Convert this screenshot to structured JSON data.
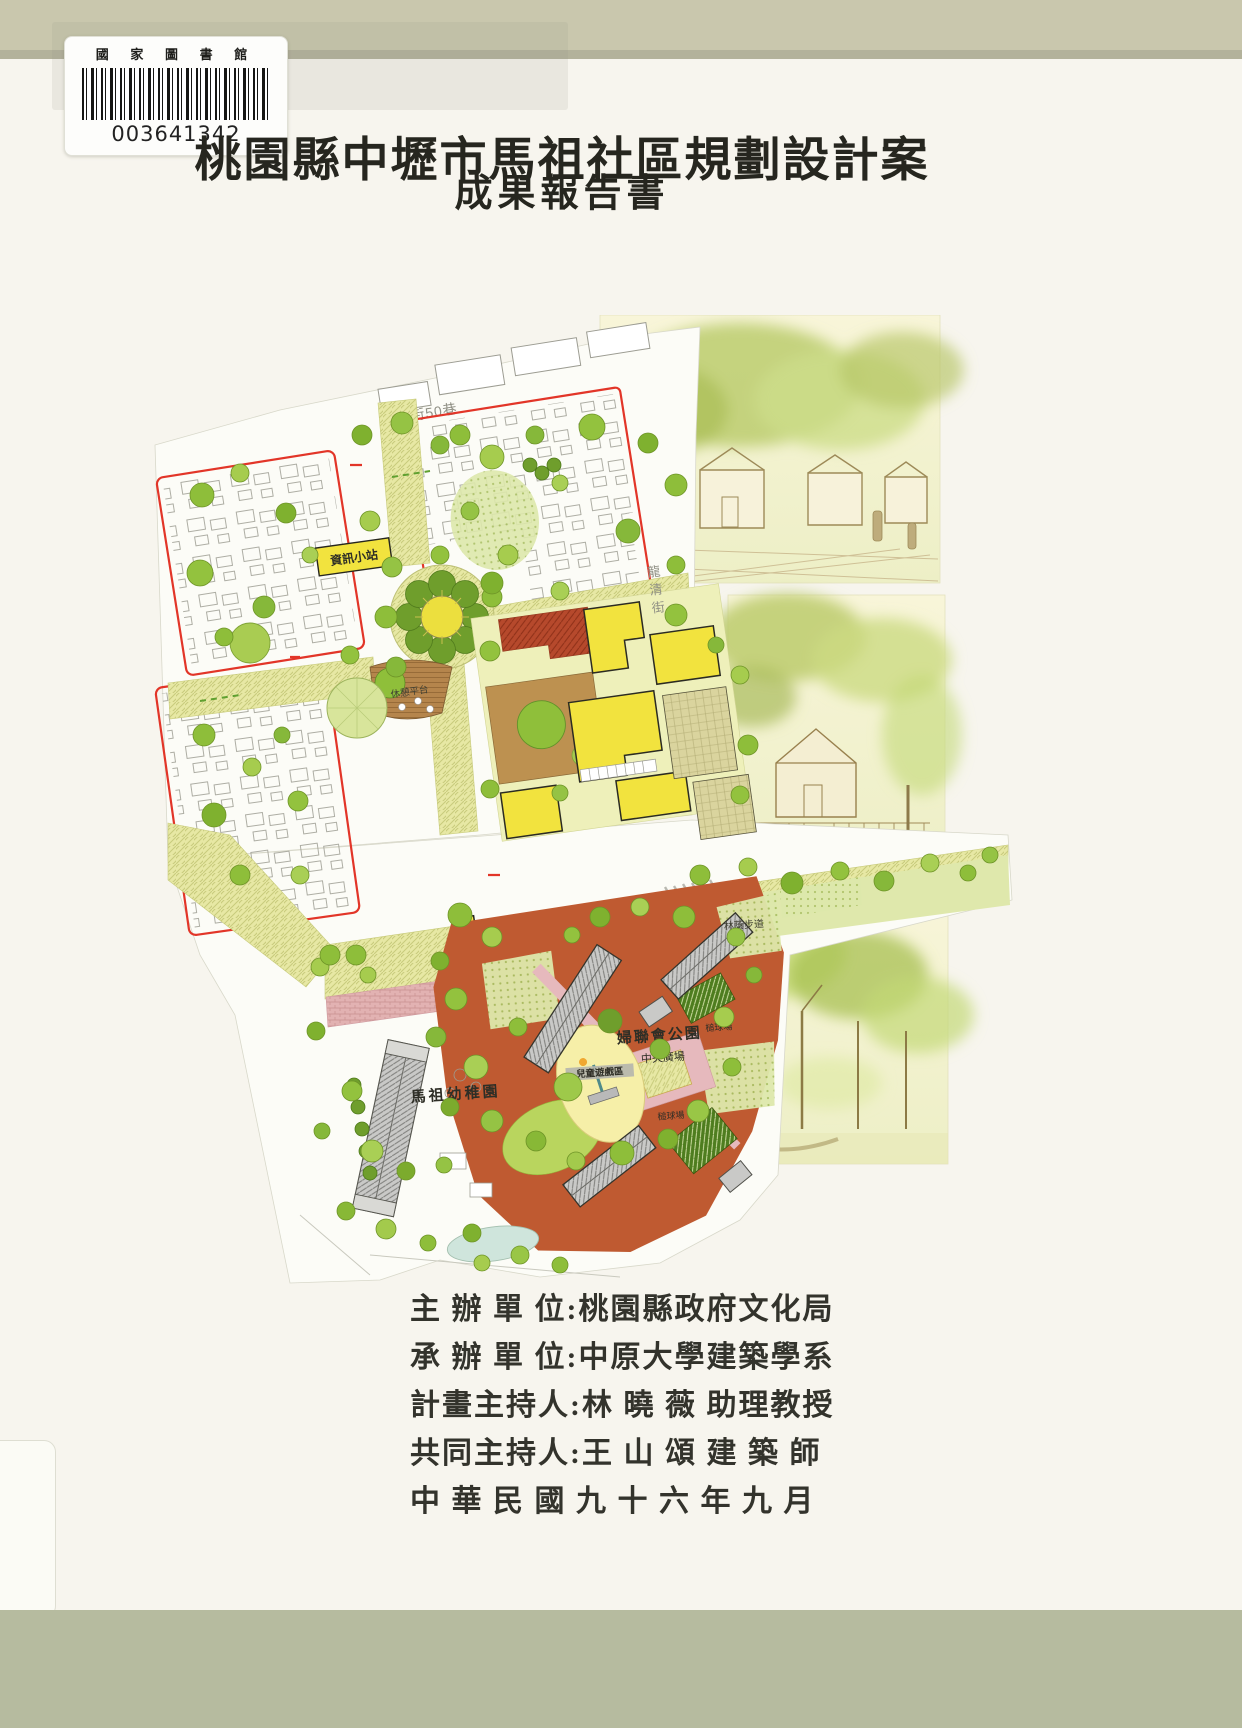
{
  "cover": {
    "library_label": {
      "institution": "國 家 圖 書 館",
      "barcode_number": "003641342"
    },
    "title": "桃園縣中壢市馬祖社區規劃設計案",
    "subtitle": "成果報告書",
    "credits": [
      "主 辦 單 位:桃園縣政府文化局",
      "承 辦 單 位:中原大學建築學系",
      "計畫主持人:林 曉 薇 助理教授",
      "共同主持人:王 山 頌 建 築 師",
      "中 華 民 國 九 十 六 年 九 月"
    ]
  },
  "site_plan": {
    "labels": {
      "street_top": "龍清街50巷",
      "street_right": "龍清街",
      "info_station": "資訊小站",
      "rest_deck": "休憩平台",
      "activity_center": "活動中心",
      "kindergarten": "馬祖幼稚園",
      "children_play_area": "兒童遊戲區",
      "womens_league_park": "婦聯會公園",
      "central_plaza": "中央廣場",
      "croquet_court_a": "槌球場",
      "croquet_court_b": "槌球場",
      "tree_lined_path": "林蔭步道"
    }
  },
  "colors": {
    "cover_strip": "#c9c7ad",
    "page_background": "#f7f5ee",
    "boundary_red": "#e23528",
    "road_yellow": "#e7e8a4",
    "park_terracotta": "#bf5a31",
    "building_yellow": "#f2e33e"
  }
}
